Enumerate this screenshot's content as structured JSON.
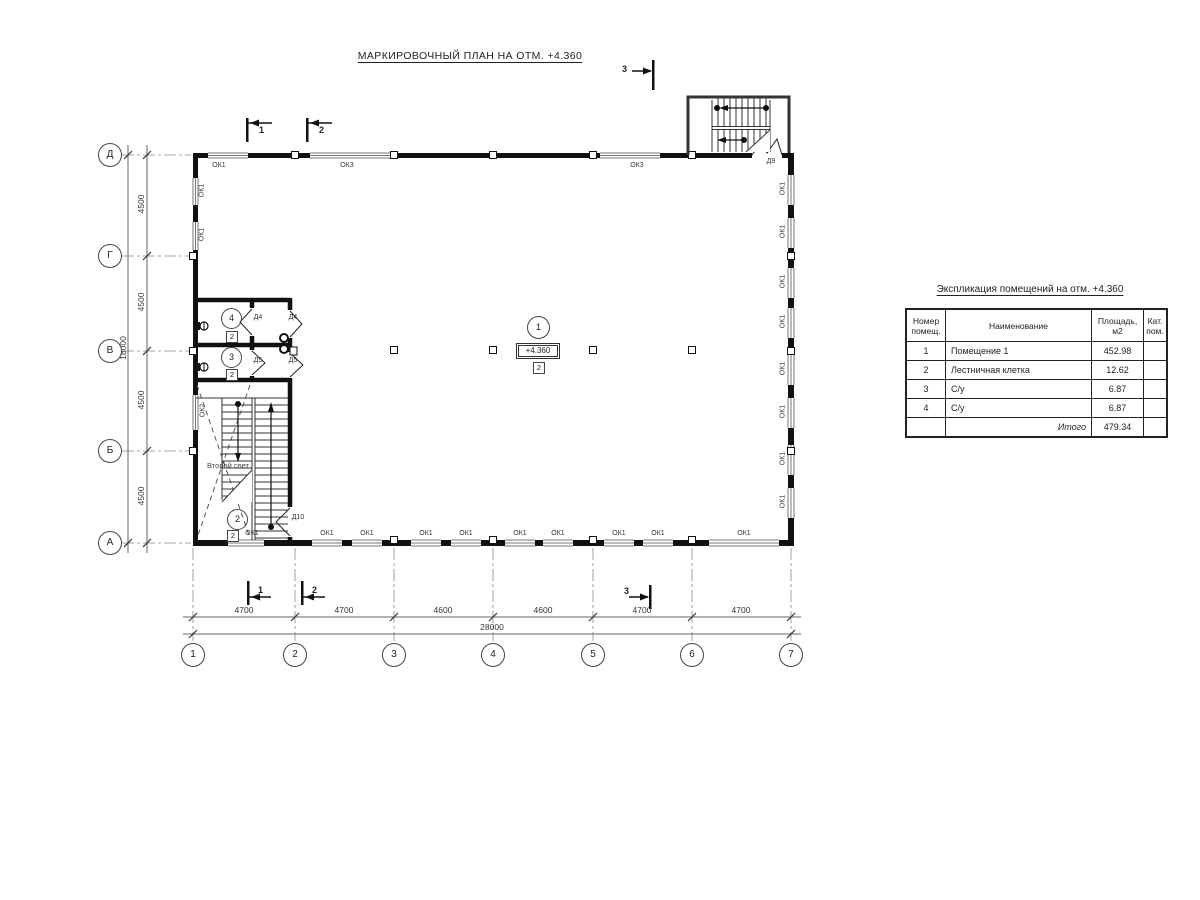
{
  "drawing": {
    "title": "МАРКИРОВОЧНЫЙ ПЛАН НА ОТМ. +4.360",
    "level_mark": "+4.360",
    "second_light": "Второй свет"
  },
  "axes": {
    "bottom": [
      "1",
      "2",
      "3",
      "4",
      "5",
      "6",
      "7"
    ],
    "left": [
      "Д",
      "Г",
      "В",
      "Б",
      "А"
    ]
  },
  "dims": {
    "bottom": [
      "4700",
      "4700",
      "4600",
      "4600",
      "4700",
      "4700"
    ],
    "bottom_total": "28000",
    "left": [
      "4500",
      "4500",
      "4500",
      "4500"
    ],
    "left_total": "18000"
  },
  "sections": {
    "s1": "1",
    "s2": "2",
    "s3": "3"
  },
  "marks": {
    "ok1": "ОК1",
    "ok2": "ОК2",
    "ok3": "ОК3",
    "d4": "Д4",
    "d5": "Д5",
    "d9": "Д9",
    "d10": "Д10"
  },
  "rooms": {
    "r1": {
      "num": "1",
      "cat": "2"
    },
    "r2": {
      "num": "2",
      "cat": "2"
    },
    "r3": {
      "num": "3",
      "cat": "2"
    },
    "r4": {
      "num": "4",
      "cat": "2"
    }
  },
  "table": {
    "title": "Экспликация помещений на отм. +4.360",
    "headers": {
      "num1": "Номер",
      "num2": "помещ.",
      "name": "Наименование",
      "area": "Площадь,  м2",
      "cat1": "Кат.",
      "cat2": "пом."
    },
    "rows": [
      {
        "num": "1",
        "name": "Помещение 1",
        "area": "452.98"
      },
      {
        "num": "2",
        "name": "Лестничная клетка",
        "area": "12.62"
      },
      {
        "num": "3",
        "name": "С/у",
        "area": "6.87"
      },
      {
        "num": "4",
        "name": "С/у",
        "area": "6.87"
      }
    ],
    "total_label": "Итого",
    "total_value": "479.34"
  }
}
